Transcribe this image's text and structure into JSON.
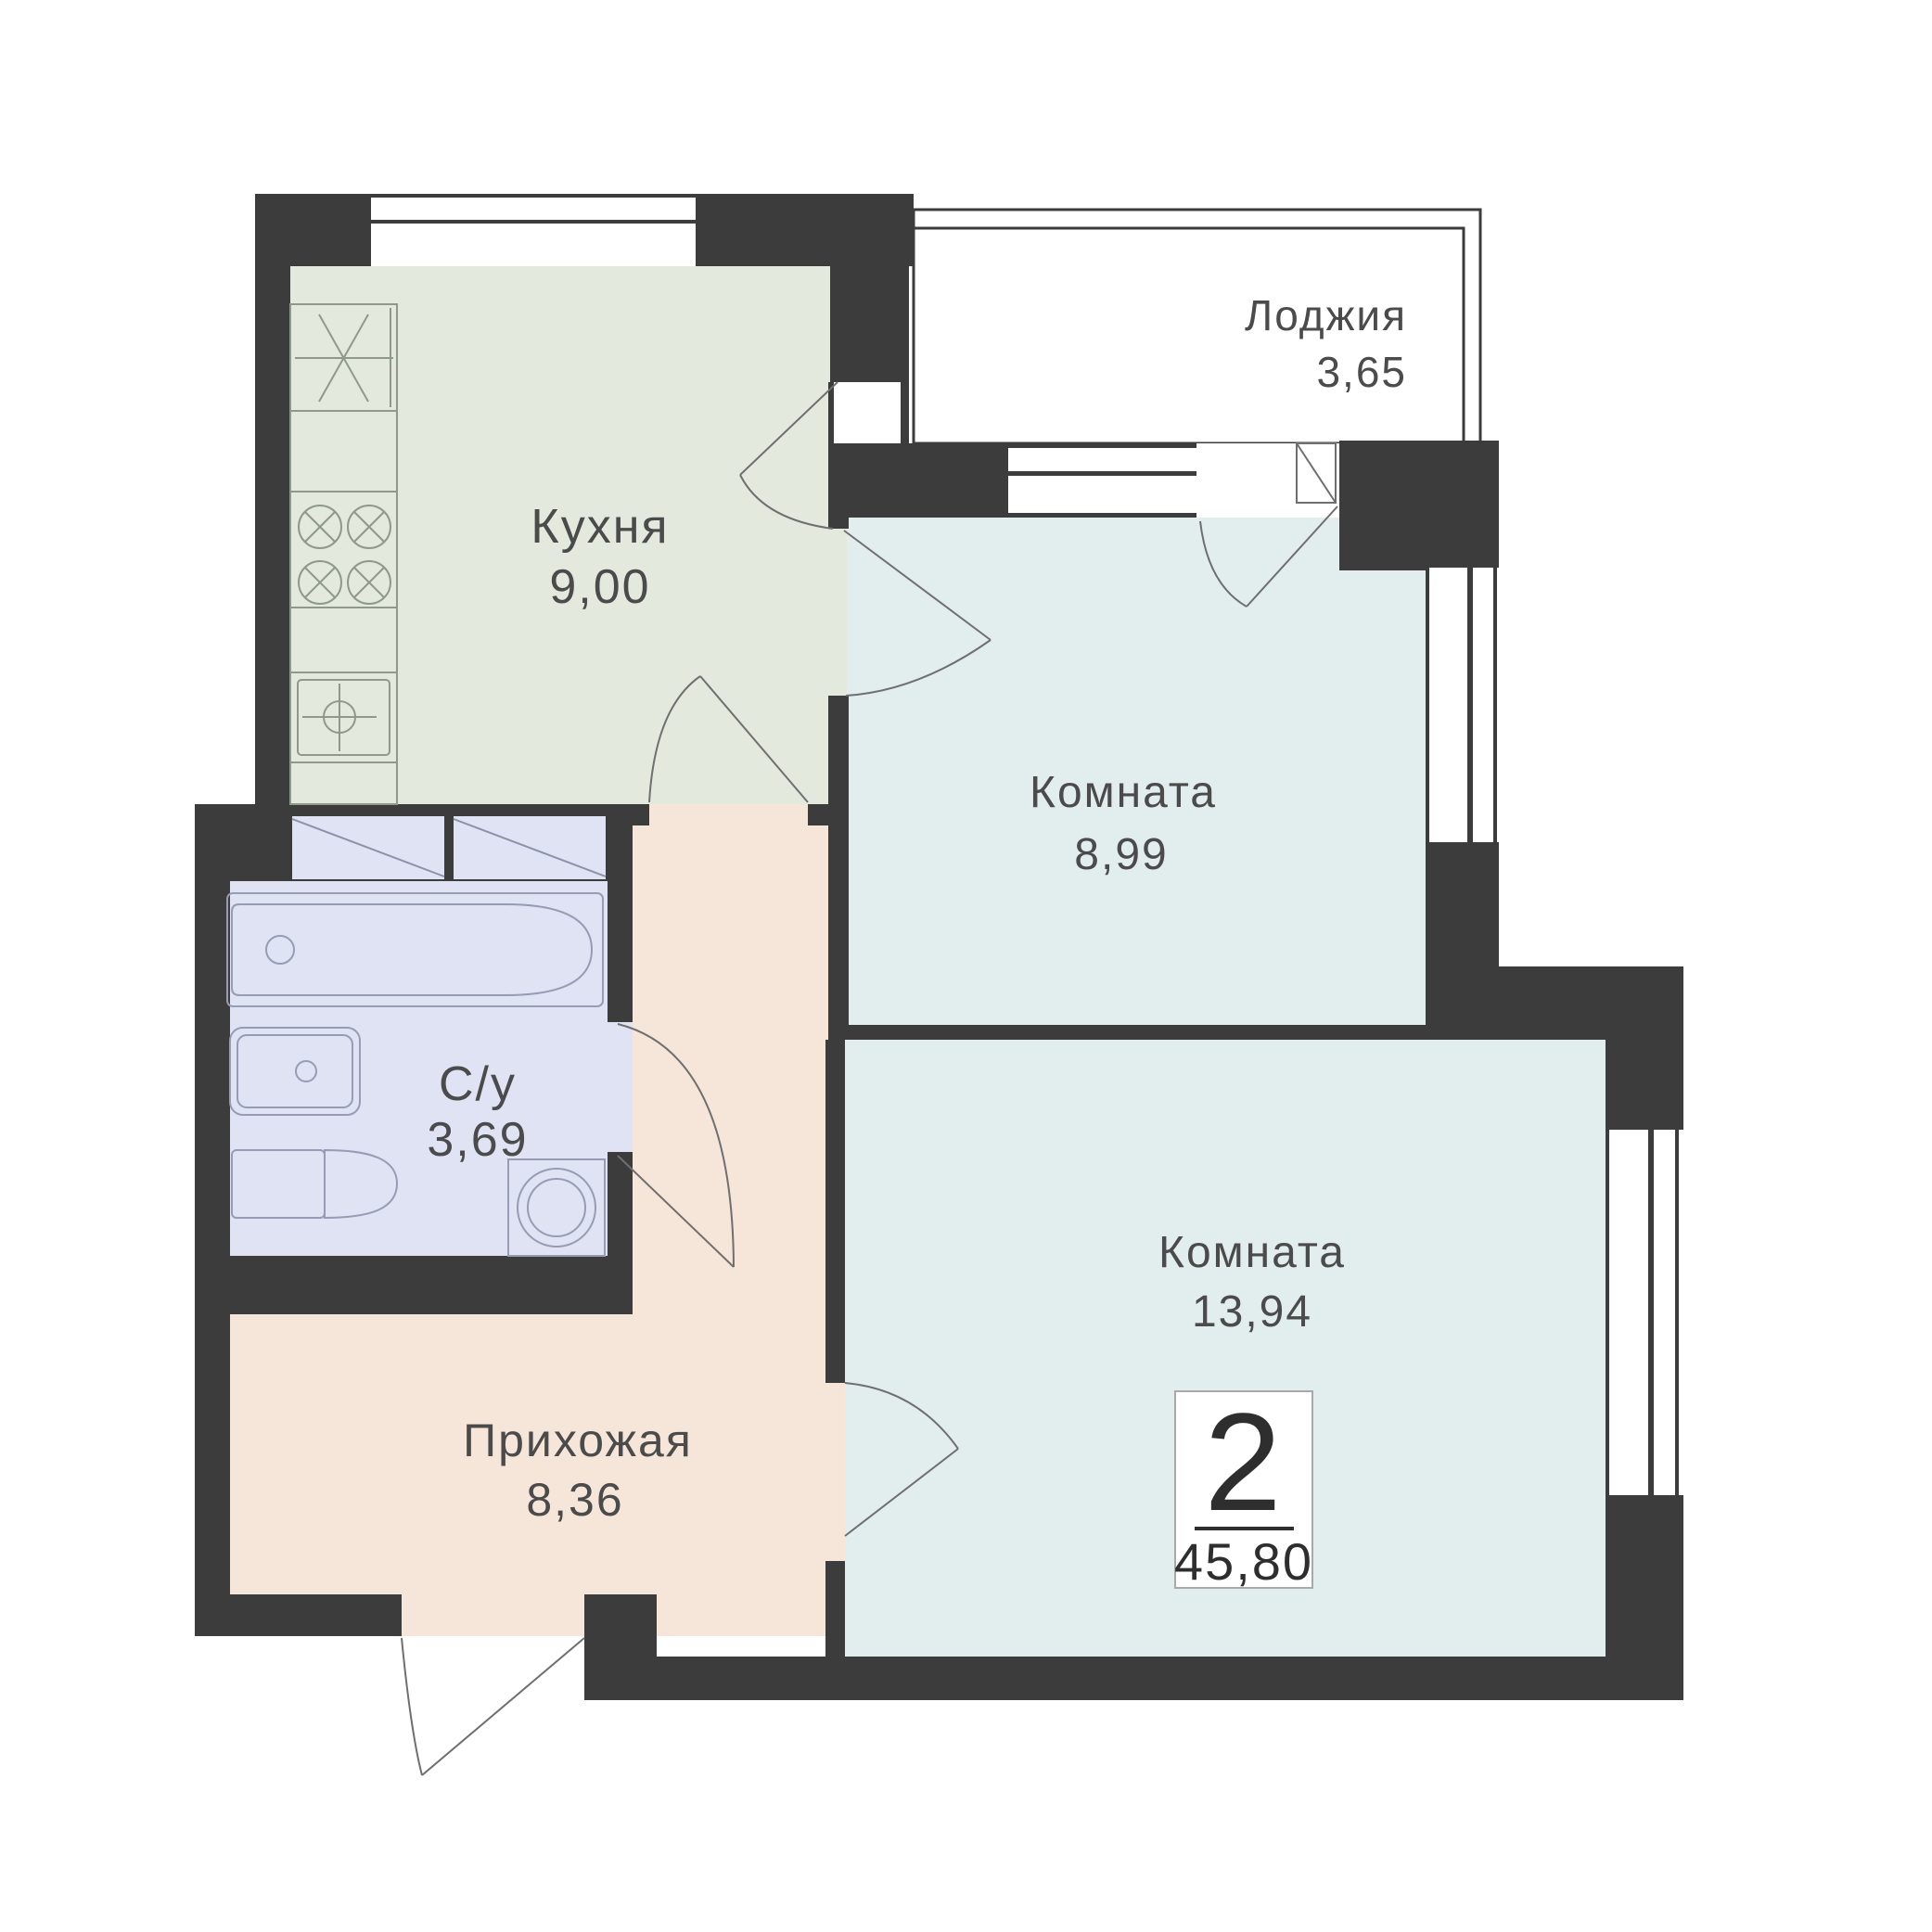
{
  "colors": {
    "wall": "#3c3c3c",
    "kitchen_floor": "#e3e9dd",
    "hallway_floor": "#f6e6da",
    "bathroom_floor": "#dfe3f3",
    "room_floor": "#e2eeee",
    "loggia_floor": "#f7e7db",
    "label_text": "#4b4b4b",
    "badge_text": "#2e2e2e",
    "badge_border": "#a9a9a9",
    "window_white": "#ffffff"
  },
  "rooms": {
    "kitchen": {
      "label": "Кухня",
      "area": "9,00"
    },
    "loggia": {
      "label": "Лоджия",
      "area": "3,65"
    },
    "room1": {
      "label": "Комната",
      "area": "8,99"
    },
    "bathroom": {
      "label": "С/у",
      "area": "3,69"
    },
    "hallway": {
      "label": "Прихожая",
      "area": "8,36"
    },
    "room2": {
      "label": "Комната",
      "area": "13,94"
    }
  },
  "badge": {
    "rooms_count": "2",
    "total_area": "45,80"
  }
}
